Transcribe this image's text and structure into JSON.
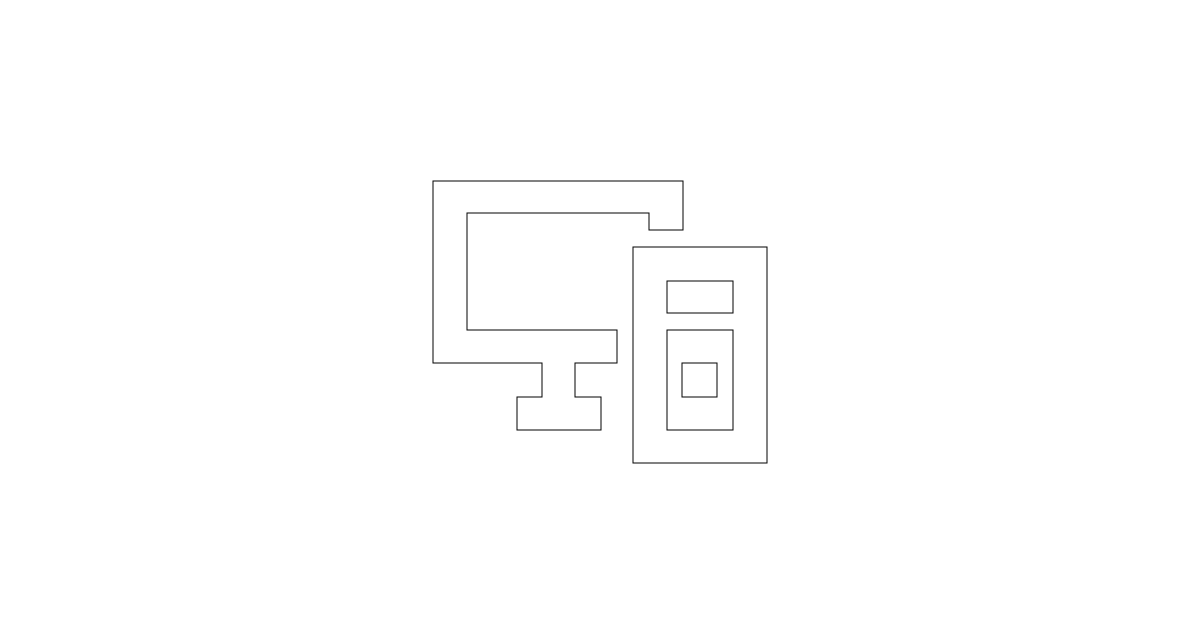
{
  "canvas": {
    "width": 1200,
    "height": 628,
    "background_color": "#ffffff"
  },
  "icon": {
    "name": "desktop-computer-icon",
    "description": "line-art pictogram of a desktop monitor with stand and a PC tower case",
    "stroke_color": "#000000",
    "stroke_width": 1,
    "fill_color": "#ffffff",
    "shapes": [
      {
        "type": "path",
        "name": "monitor-with-stand-outline",
        "closed": true,
        "points": [
          [
            433,
            181
          ],
          [
            683,
            181
          ],
          [
            683,
            230
          ],
          [
            649,
            230
          ],
          [
            649,
            213
          ],
          [
            467,
            213
          ],
          [
            467,
            330
          ],
          [
            617,
            330
          ],
          [
            617,
            363
          ],
          [
            575,
            363
          ],
          [
            575,
            397
          ],
          [
            601,
            397
          ],
          [
            601,
            430
          ],
          [
            517,
            430
          ],
          [
            517,
            397
          ],
          [
            542,
            397
          ],
          [
            542,
            363
          ],
          [
            433,
            363
          ]
        ]
      },
      {
        "type": "rect",
        "name": "tower-case-outline",
        "x": 633,
        "y": 247,
        "width": 134,
        "height": 216
      },
      {
        "type": "rect",
        "name": "tower-drive-bay",
        "x": 667,
        "y": 281,
        "width": 66,
        "height": 32
      },
      {
        "type": "rect",
        "name": "tower-front-panel",
        "x": 667,
        "y": 330,
        "width": 66,
        "height": 100
      },
      {
        "type": "rect",
        "name": "tower-power-button",
        "x": 682,
        "y": 363,
        "width": 35,
        "height": 34
      }
    ]
  }
}
